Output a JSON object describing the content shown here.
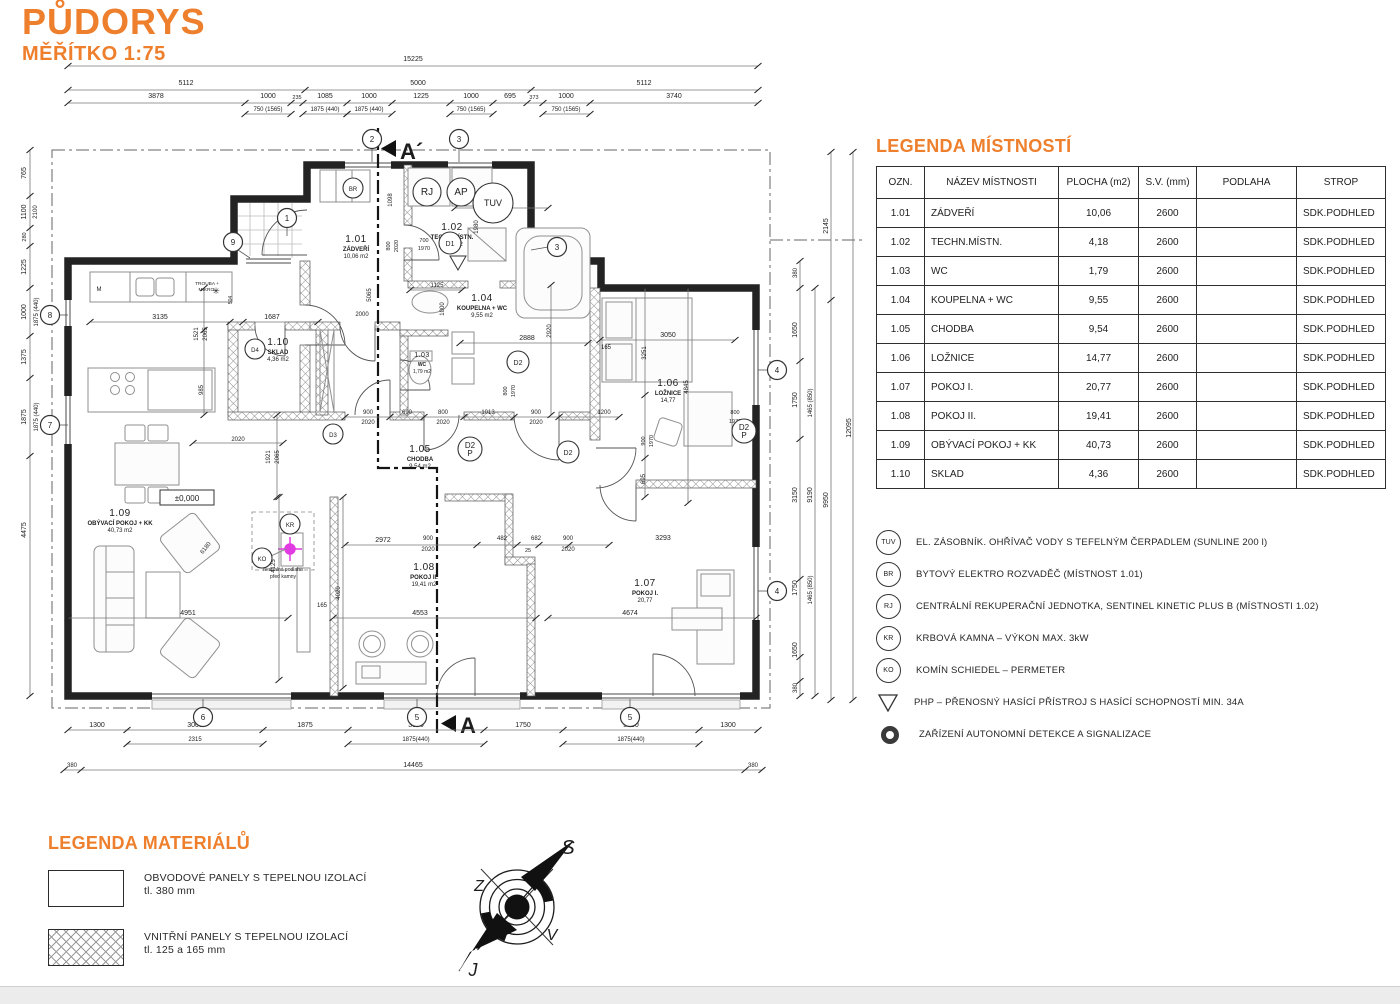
{
  "title": {
    "heading": "PŮDORYS",
    "scale": "MĚŘÍTKO 1:75"
  },
  "colors": {
    "accent": "#EE7F2D",
    "magenta": "#E23BE2",
    "line": "#222222"
  },
  "rooms_legend": {
    "heading": "LEGENDA MÍSTNOSTÍ",
    "columns": [
      "OZN.",
      "NÁZEV MÍSTNOSTI",
      "PLOCHA (m2)",
      "S.V. (mm)",
      "PODLAHA",
      "STROP"
    ],
    "rows": [
      {
        "ozn": "1.01",
        "nazev": "ZÁDVEŘÍ",
        "plocha": "10,06",
        "sv": "2600",
        "podlaha": "",
        "strop": "SDK.PODHLED"
      },
      {
        "ozn": "1.02",
        "nazev": "TECHN.MÍSTN.",
        "plocha": "4,18",
        "sv": "2600",
        "podlaha": "",
        "strop": "SDK.PODHLED"
      },
      {
        "ozn": "1.03",
        "nazev": "WC",
        "plocha": "1,79",
        "sv": "2600",
        "podlaha": "",
        "strop": "SDK.PODHLED"
      },
      {
        "ozn": "1.04",
        "nazev": "KOUPELNA + WC",
        "plocha": "9,55",
        "sv": "2600",
        "podlaha": "",
        "strop": "SDK.PODHLED"
      },
      {
        "ozn": "1.05",
        "nazev": "CHODBA",
        "plocha": "9,54",
        "sv": "2600",
        "podlaha": "",
        "strop": "SDK.PODHLED"
      },
      {
        "ozn": "1.06",
        "nazev": "LOŽNICE",
        "plocha": "14,77",
        "sv": "2600",
        "podlaha": "",
        "strop": "SDK.PODHLED"
      },
      {
        "ozn": "1.07",
        "nazev": "POKOJ I.",
        "plocha": "20,77",
        "sv": "2600",
        "podlaha": "",
        "strop": "SDK.PODHLED"
      },
      {
        "ozn": "1.08",
        "nazev": "POKOJ II.",
        "plocha": "19,41",
        "sv": "2600",
        "podlaha": "",
        "strop": "SDK.PODHLED"
      },
      {
        "ozn": "1.09",
        "nazev": "OBÝVACÍ POKOJ + KK",
        "plocha": "40,73",
        "sv": "2600",
        "podlaha": "",
        "strop": "SDK.PODHLED"
      },
      {
        "ozn": "1.10",
        "nazev": "SKLAD",
        "plocha": "4,36",
        "sv": "2600",
        "podlaha": "",
        "strop": "SDK.PODHLED"
      }
    ]
  },
  "symbols_legend": {
    "items": [
      {
        "symbol": "TUV",
        "shape": "circle",
        "text": "EL. ZÁSOBNÍK. OHŘÍVAČ VODY S TEFELNÝM ČERPADLEM (SUNLINE 200 l)"
      },
      {
        "symbol": "BR",
        "shape": "circle",
        "text": "BYTOVÝ ELEKTRO ROZVADĚČ (MÍSTNOST 1.01)"
      },
      {
        "symbol": "RJ",
        "shape": "circle",
        "text": "CENTRÁLNÍ REKUPERAČNÍ JEDNOTKA, SENTINEL KINETIC PLUS B (MÍSTNOSTI 1.02)"
      },
      {
        "symbol": "KR",
        "shape": "circle",
        "text": "KRBOVÁ KAMNA – VÝKON MAX. 3kW"
      },
      {
        "symbol": "KO",
        "shape": "circle",
        "text": "KOMÍN SCHIEDEL – PERMETER"
      },
      {
        "symbol": "",
        "shape": "triangle",
        "text": "PHP – PŘENOSNÝ HASÍCÍ PŘÍSTROJ S HASÍCÍ SCHOPNOSTÍ MIN. 34A"
      },
      {
        "symbol": "",
        "shape": "donut",
        "text": "ZAŘÍZENÍ AUTONOMNÍ DETEKCE A SIGNALIZACE"
      }
    ]
  },
  "materials_legend": {
    "heading": "LEGENDA MATERIÁLŮ",
    "items": [
      {
        "line1": "OBVODOVÉ PANELY S TEPELNOU IZOLACÍ",
        "line2": "tl. 380 mm",
        "pattern": "solid"
      },
      {
        "line1": "VNITŘNÍ PANELY S TEPELNOU IZOLACÍ",
        "line2": "tl. 125 a 165 mm",
        "pattern": "crosshatch"
      }
    ]
  },
  "compass": {
    "n": "S",
    "w": "Z",
    "e": "V",
    "s": "J"
  },
  "plan": {
    "section_top": "A´",
    "section_bottom": "A",
    "level": "±0,000",
    "rooms": [
      {
        "num": "1.01",
        "name": "ZÁDVEŘÍ",
        "area": "10,06 m2",
        "x": 356,
        "y": 242
      },
      {
        "num": "1.02",
        "name": "TECHN.MÍSTN.",
        "area": "4,18 m2",
        "x": 452,
        "y": 230
      },
      {
        "num": "1.03",
        "name": "WC",
        "area": "1,79 m2",
        "x": 422,
        "y": 357,
        "small": true
      },
      {
        "num": "1.04",
        "name": "KOUPELNA + WC",
        "area": "9,55 m2",
        "x": 482,
        "y": 301
      },
      {
        "num": "1.05",
        "name": "CHODBA",
        "area": "9,54 m2",
        "x": 420,
        "y": 452
      },
      {
        "num": "1.06",
        "name": "LOŽNICE",
        "area": "14,77",
        "x": 668,
        "y": 386
      },
      {
        "num": "1.07",
        "name": "POKOJ I.",
        "area": "20,77",
        "x": 645,
        "y": 586
      },
      {
        "num": "1.08",
        "name": "POKOJ II.",
        "area": "19,41 m2",
        "x": 424,
        "y": 570
      },
      {
        "num": "1.09",
        "name": "OBÝVACÍ POKOJ + KK",
        "area": "40,73 m2",
        "x": 120,
        "y": 516
      },
      {
        "num": "1.10",
        "name": "SKLAD",
        "area": "4,36 m2",
        "x": 278,
        "y": 345
      }
    ],
    "grid_bubbles": [
      {
        "n": "2",
        "x": 372,
        "y": 139
      },
      {
        "n": "3",
        "x": 459,
        "y": 139
      },
      {
        "n": "3",
        "x": 557,
        "y": 247
      },
      {
        "n": "1",
        "x": 287,
        "y": 218
      },
      {
        "n": "9",
        "x": 233,
        "y": 242
      },
      {
        "n": "8",
        "x": 50,
        "y": 315
      },
      {
        "n": "7",
        "x": 50,
        "y": 425
      },
      {
        "n": "4",
        "x": 777,
        "y": 370
      },
      {
        "n": "4",
        "x": 777,
        "y": 591
      },
      {
        "n": "6",
        "x": 203,
        "y": 717
      },
      {
        "n": "5",
        "x": 417,
        "y": 717
      },
      {
        "n": "5",
        "x": 630,
        "y": 717
      }
    ],
    "device_circles": [
      {
        "t": "TUV",
        "x": 493,
        "y": 203,
        "r": 20
      },
      {
        "t": "RJ",
        "x": 427,
        "y": 192,
        "r": 14
      },
      {
        "t": "AP",
        "x": 461,
        "y": 192,
        "r": 14
      },
      {
        "t": "BR",
        "x": 353,
        "y": 188,
        "r": 10
      },
      {
        "t": "KR",
        "x": 290,
        "y": 524,
        "r": 10
      },
      {
        "t": "KO",
        "x": 262,
        "y": 558,
        "r": 10
      },
      {
        "t": "D1",
        "x": 450,
        "y": 243,
        "r": 11
      },
      {
        "t": "D2",
        "x": 518,
        "y": 362,
        "r": 11
      },
      {
        "t": "D4",
        "x": 255,
        "y": 349,
        "r": 10
      },
      {
        "t": "D3",
        "x": 333,
        "y": 434,
        "r": 10
      },
      {
        "t": "D2/P",
        "x": 470,
        "y": 449,
        "r": 12
      },
      {
        "t": "D2",
        "x": 568,
        "y": 452,
        "r": 11
      },
      {
        "t": "D2/P",
        "x": 744,
        "y": 431,
        "r": 12
      }
    ],
    "labels": [
      {
        "t": "15225",
        "x": 413,
        "y": 61
      },
      {
        "t": "5112",
        "x": 186,
        "y": 85
      },
      {
        "t": "5000",
        "x": 418,
        "y": 85
      },
      {
        "t": "5112",
        "x": 644,
        "y": 85
      },
      {
        "t": "3878",
        "x": 156,
        "y": 98
      },
      {
        "t": "1000",
        "x": 268,
        "y": 98
      },
      {
        "t": "235",
        "x": 297,
        "y": 99,
        "s": 5.5
      },
      {
        "t": "1085",
        "x": 325,
        "y": 98
      },
      {
        "t": "1000",
        "x": 369,
        "y": 98
      },
      {
        "t": "1225",
        "x": 421,
        "y": 98
      },
      {
        "t": "1000",
        "x": 471,
        "y": 98
      },
      {
        "t": "695",
        "x": 510,
        "y": 98
      },
      {
        "t": "373",
        "x": 534,
        "y": 99,
        "s": 5.5
      },
      {
        "t": "1000",
        "x": 566,
        "y": 98
      },
      {
        "t": "3740",
        "x": 674,
        "y": 98
      },
      {
        "t": "750 (1565)",
        "x": 268,
        "y": 111,
        "s": 6
      },
      {
        "t": "1875 (440)",
        "x": 325,
        "y": 111,
        "s": 6
      },
      {
        "t": "1875 (440)",
        "x": 369,
        "y": 111,
        "s": 6
      },
      {
        "t": "750 (1565)",
        "x": 471,
        "y": 111,
        "s": 6
      },
      {
        "t": "750 (1565)",
        "x": 566,
        "y": 111,
        "s": 6
      },
      {
        "t": "1300",
        "x": 97,
        "y": 727
      },
      {
        "t": "3000",
        "x": 195,
        "y": 727
      },
      {
        "t": "1875",
        "x": 305,
        "y": 727
      },
      {
        "t": "3000",
        "x": 416,
        "y": 727
      },
      {
        "t": "1750",
        "x": 523,
        "y": 727
      },
      {
        "t": "3000",
        "x": 631,
        "y": 727
      },
      {
        "t": "1300",
        "x": 728,
        "y": 727
      },
      {
        "t": "2315",
        "x": 195,
        "y": 741,
        "s": 6
      },
      {
        "t": "1875(440)",
        "x": 416,
        "y": 741,
        "s": 6
      },
      {
        "t": "1875(440)",
        "x": 631,
        "y": 741,
        "s": 6
      },
      {
        "t": "380",
        "x": 72,
        "y": 767,
        "s": 6
      },
      {
        "t": "14465",
        "x": 413,
        "y": 767
      },
      {
        "t": "380",
        "x": 753,
        "y": 767,
        "s": 6
      },
      {
        "t": "765",
        "x": 26,
        "y": 173,
        "r": -90
      },
      {
        "t": "1100",
        "x": 26,
        "y": 212,
        "r": -90
      },
      {
        "t": "2100",
        "x": 37,
        "y": 212,
        "r": -90,
        "s": 6
      },
      {
        "t": "280",
        "x": 26,
        "y": 237,
        "r": -90,
        "s": 5.5
      },
      {
        "t": "1225",
        "x": 26,
        "y": 267,
        "r": -90
      },
      {
        "t": "1000",
        "x": 26,
        "y": 312,
        "r": -90
      },
      {
        "t": "1875 (440)",
        "x": 38,
        "y": 312,
        "r": -90,
        "s": 6
      },
      {
        "t": "1375",
        "x": 26,
        "y": 357,
        "r": -90
      },
      {
        "t": "1875",
        "x": 26,
        "y": 417,
        "r": -90
      },
      {
        "t": "1875 (440)",
        "x": 38,
        "y": 417,
        "r": -90,
        "s": 6
      },
      {
        "t": "4475",
        "x": 26,
        "y": 530,
        "r": -90
      },
      {
        "t": "2145",
        "x": 828,
        "y": 226,
        "r": -90
      },
      {
        "t": "380",
        "x": 797,
        "y": 273,
        "r": -90,
        "s": 6
      },
      {
        "t": "1650",
        "x": 797,
        "y": 330,
        "r": -90
      },
      {
        "t": "1750",
        "x": 797,
        "y": 400,
        "r": -90
      },
      {
        "t": "1465 (850)",
        "x": 812,
        "y": 403,
        "r": -90,
        "s": 6
      },
      {
        "t": "3150",
        "x": 797,
        "y": 495,
        "r": -90
      },
      {
        "t": "9190",
        "x": 812,
        "y": 495,
        "r": -90
      },
      {
        "t": "9950",
        "x": 828,
        "y": 500,
        "r": -90
      },
      {
        "t": "1750",
        "x": 797,
        "y": 588,
        "r": -90
      },
      {
        "t": "1465 (850)",
        "x": 812,
        "y": 590,
        "r": -90,
        "s": 6
      },
      {
        "t": "1650",
        "x": 797,
        "y": 650,
        "r": -90
      },
      {
        "t": "380",
        "x": 797,
        "y": 688,
        "r": -90,
        "s": 6
      },
      {
        "t": "12095",
        "x": 851,
        "y": 428,
        "r": -90
      },
      {
        "t": "3135",
        "x": 160,
        "y": 319
      },
      {
        "t": "1687",
        "x": 272,
        "y": 319
      },
      {
        "t": "2000",
        "x": 362,
        "y": 316,
        "s": 6
      },
      {
        "t": "5065",
        "x": 371,
        "y": 295,
        "r": -90,
        "s": 6
      },
      {
        "t": "1098",
        "x": 392,
        "y": 200,
        "r": -90,
        "s": 6
      },
      {
        "t": "2115",
        "x": 500,
        "y": 205
      },
      {
        "t": "1980",
        "x": 478,
        "y": 227,
        "r": -90,
        "s": 6
      },
      {
        "t": "1125",
        "x": 437,
        "y": 287,
        "s": 6
      },
      {
        "t": "2888",
        "x": 527,
        "y": 340
      },
      {
        "t": "2920",
        "x": 551,
        "y": 331,
        "r": -90,
        "s": 6
      },
      {
        "t": "3050",
        "x": 668,
        "y": 337
      },
      {
        "t": "165",
        "x": 606,
        "y": 349,
        "s": 6
      },
      {
        "t": "3251",
        "x": 646,
        "y": 353,
        "r": -90,
        "s": 6
      },
      {
        "t": "4845",
        "x": 688,
        "y": 387,
        "r": -90,
        "s": 6
      },
      {
        "t": "1521",
        "x": 198,
        "y": 334,
        "r": -90,
        "s": 6
      },
      {
        "t": "2065",
        "x": 207,
        "y": 334,
        "r": -90,
        "s": 6
      },
      {
        "t": "985",
        "x": 203,
        "y": 390,
        "r": -90,
        "s": 6
      },
      {
        "t": "504",
        "x": 232,
        "y": 300,
        "r": -90,
        "s": 5
      },
      {
        "t": "2020",
        "x": 238,
        "y": 441,
        "s": 6
      },
      {
        "t": "1921",
        "x": 270,
        "y": 457,
        "r": -90,
        "s": 6
      },
      {
        "t": "2065",
        "x": 279,
        "y": 457,
        "r": -90,
        "s": 6
      },
      {
        "t": "900",
        "x": 368,
        "y": 414,
        "s": 6
      },
      {
        "t": "2020",
        "x": 368,
        "y": 424,
        "s": 6
      },
      {
        "t": "690",
        "x": 407,
        "y": 414,
        "s": 6
      },
      {
        "t": "800",
        "x": 443,
        "y": 414,
        "s": 6
      },
      {
        "t": "2020",
        "x": 443,
        "y": 424,
        "s": 6
      },
      {
        "t": "1013",
        "x": 488,
        "y": 414,
        "s": 6
      },
      {
        "t": "900",
        "x": 536,
        "y": 414,
        "s": 6
      },
      {
        "t": "2020",
        "x": 536,
        "y": 424,
        "s": 6
      },
      {
        "t": "1200",
        "x": 604,
        "y": 414,
        "s": 6
      },
      {
        "t": "700",
        "x": 424,
        "y": 242,
        "s": 5.5
      },
      {
        "t": "1970",
        "x": 424,
        "y": 250,
        "s": 5.5
      },
      {
        "t": "800",
        "x": 390,
        "y": 246,
        "r": -90,
        "s": 5.5
      },
      {
        "t": "2020",
        "x": 398,
        "y": 246,
        "r": -90,
        "s": 5.5
      },
      {
        "t": "800",
        "x": 507,
        "y": 391,
        "r": -90,
        "s": 5.5
      },
      {
        "t": "1970",
        "x": 515,
        "y": 391,
        "r": -90,
        "s": 5.5
      },
      {
        "t": "900",
        "x": 645,
        "y": 441,
        "r": -90,
        "s": 5.5
      },
      {
        "t": "1970",
        "x": 653,
        "y": 441,
        "r": -90,
        "s": 5.5
      },
      {
        "t": "800",
        "x": 735,
        "y": 414,
        "s": 5.5
      },
      {
        "t": "1970",
        "x": 735,
        "y": 423,
        "s": 5.5
      },
      {
        "t": "695",
        "x": 645,
        "y": 479,
        "r": -90,
        "s": 6
      },
      {
        "t": "1000",
        "x": 444,
        "y": 309,
        "r": -90,
        "s": 6
      },
      {
        "t": "2972",
        "x": 383,
        "y": 542
      },
      {
        "t": "900",
        "x": 428,
        "y": 540,
        "s": 6
      },
      {
        "t": "2020",
        "x": 428,
        "y": 551,
        "s": 6
      },
      {
        "t": "482",
        "x": 502,
        "y": 540,
        "s": 6
      },
      {
        "t": "682",
        "x": 536,
        "y": 540,
        "s": 6
      },
      {
        "t": "25",
        "x": 528,
        "y": 552,
        "s": 5.5
      },
      {
        "t": "900",
        "x": 568,
        "y": 540,
        "s": 6
      },
      {
        "t": "2020",
        "x": 568,
        "y": 551,
        "s": 6
      },
      {
        "t": "3293",
        "x": 663,
        "y": 540
      },
      {
        "t": "4951",
        "x": 188,
        "y": 615
      },
      {
        "t": "4125",
        "x": 275,
        "y": 566,
        "r": -90,
        "s": 6
      },
      {
        "t": "165",
        "x": 322,
        "y": 607,
        "s": 6
      },
      {
        "t": "6180",
        "x": 207,
        "y": 549,
        "r": -52,
        "s": 6
      },
      {
        "t": "4553",
        "x": 420,
        "y": 615
      },
      {
        "t": "4674",
        "x": 630,
        "y": 615
      },
      {
        "t": "4020",
        "x": 340,
        "y": 593,
        "r": -90,
        "s": 6
      },
      {
        "t": "TROUBA +",
        "x": 207,
        "y": 285,
        "s": 4.8
      },
      {
        "t": "MIKRO.",
        "x": 207,
        "y": 291,
        "s": 4.8
      },
      {
        "t": "M",
        "x": 99,
        "y": 291,
        "s": 6
      },
      {
        "t": "✳",
        "x": 216,
        "y": 294,
        "s": 9
      },
      {
        "t": "nespalná podlaha",
        "x": 283,
        "y": 571,
        "s": 5
      },
      {
        "t": "před kamny",
        "x": 283,
        "y": 578,
        "s": 5
      },
      {
        "t": "±0,000",
        "x": 187,
        "y": 501,
        "s": 8
      }
    ]
  }
}
